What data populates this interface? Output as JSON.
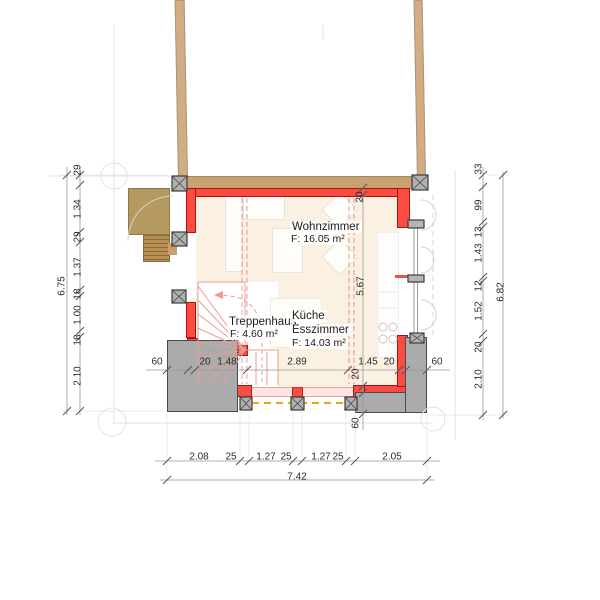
{
  "rooms": {
    "wohnzimmer": {
      "name": "Wohnzimmer",
      "area": "F: 16.05 m²"
    },
    "treppenhaus": {
      "name": "Treppenhaus",
      "area": "F: 4.60 m²"
    },
    "kueche": {
      "line1": "Küche",
      "line2": "Esszimmer",
      "area": "F: 14.03 m²"
    }
  },
  "dims": {
    "left": {
      "values": [
        "29",
        "1.34",
        "29",
        "1.37",
        "18",
        "1.00",
        "18",
        "2.10"
      ],
      "total": "6.75"
    },
    "right": {
      "values": [
        "33",
        "99",
        "13",
        "1.43",
        "12",
        "1.52",
        "20",
        "2.10"
      ],
      "total": "6.82"
    },
    "bottom": {
      "values": [
        "2.08",
        "25",
        "1.27",
        "25",
        "1.27",
        "25",
        "2.05"
      ],
      "total": "7.42"
    },
    "mid": {
      "values": [
        "60",
        "20",
        "1.48",
        "2.89",
        "1.45",
        "20",
        "60"
      ]
    },
    "inner": {
      "values": [
        "20",
        "5.67",
        "20",
        "60"
      ]
    }
  },
  "colors": {
    "wall_new": "#fb4b42",
    "wall_existing": "#c9a171",
    "concrete": "#ababab",
    "floor": "#fbf1e2",
    "axis_dash": "#e8a614"
  }
}
